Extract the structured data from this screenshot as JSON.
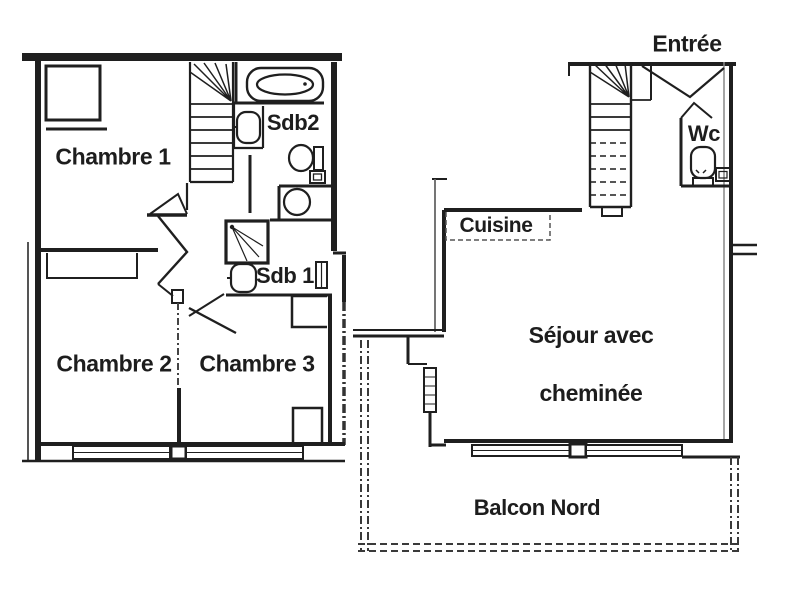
{
  "title": "Apartment floor plan",
  "labels": {
    "chambre1": "Chambre 1",
    "chambre2": "Chambre 2",
    "chambre3": "Chambre 3",
    "sdb2": "Sdb2",
    "sdb1": "Sdb 1",
    "entree": "Entrée",
    "wc": "Wc",
    "cuisine": "Cuisine",
    "sejour_line1": "Séjour avec",
    "sejour_line2": "cheminée",
    "balcon": "Balcon Nord"
  },
  "colors": {
    "wall": "#1f1f1f",
    "light_line": "#555555",
    "text": "#1d1d1d",
    "background": "#ffffff"
  },
  "fixtures": [
    "bathtub-icon",
    "sink-icon",
    "toilet-icon",
    "shower-icon",
    "washing-machine-icon",
    "stairs-icon",
    "window-icon",
    "balcony-railing-icon",
    "door-swing-icon"
  ]
}
